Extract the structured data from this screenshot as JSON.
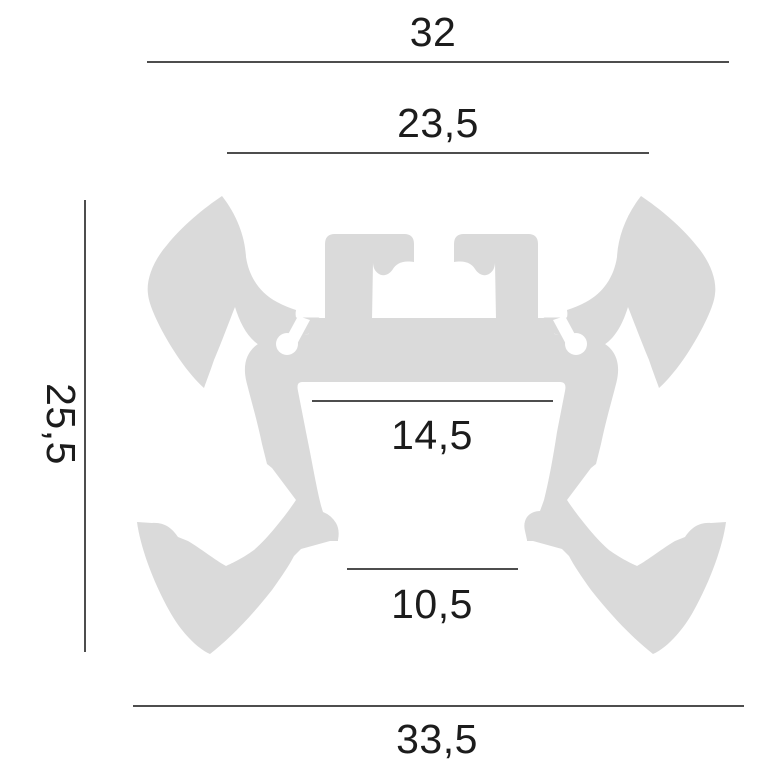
{
  "drawing": {
    "type": "technical-cross-section-profile",
    "colors": {
      "profile_fill": "#dadada",
      "dim_line": "#4d4d4d",
      "dim_text": "#1c1c1c",
      "background": "#ffffff"
    },
    "dimensions": {
      "overall_width_top": "32",
      "inner_width_top": "23,5",
      "height": "25,5",
      "cavity_width": "14,5",
      "bottom_opening": "10,5",
      "overall_width_bottom": "33,5"
    }
  }
}
